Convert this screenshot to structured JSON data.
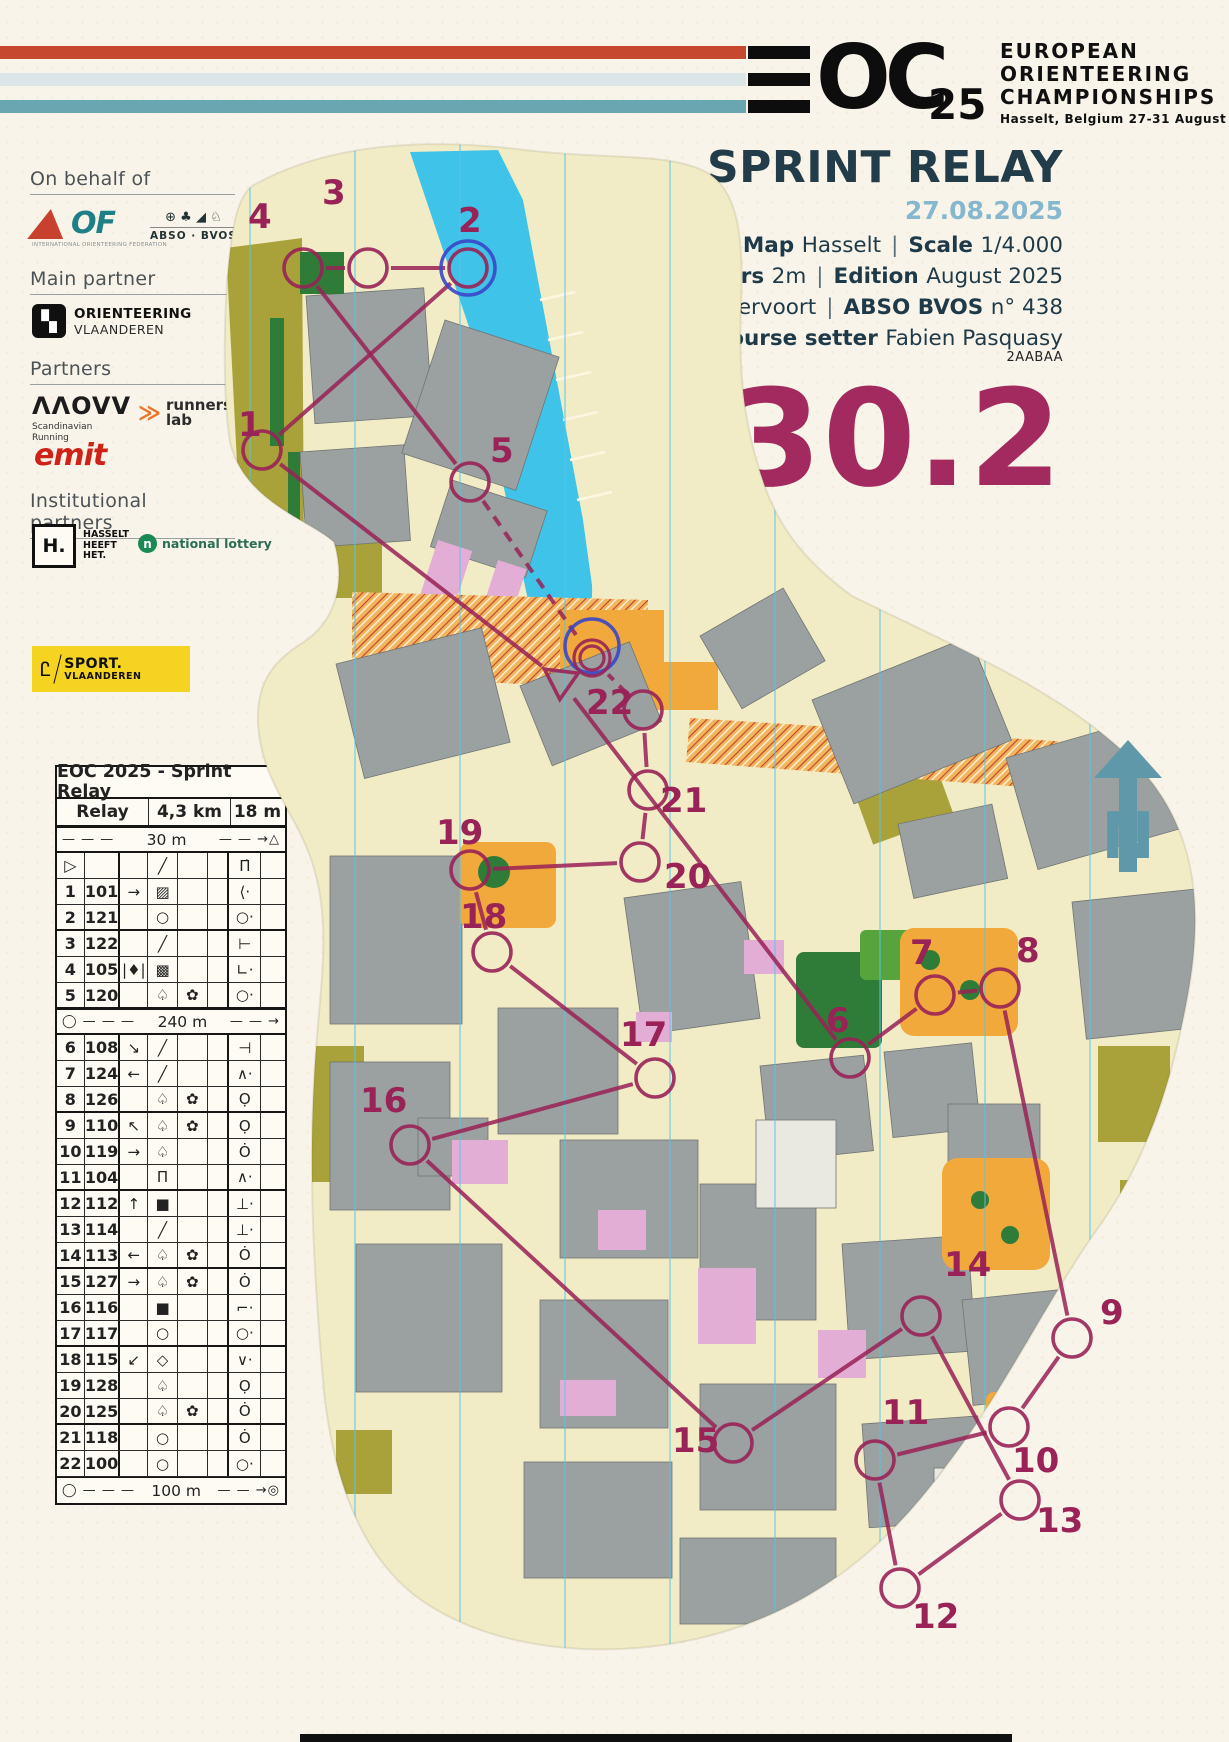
{
  "header": {
    "logo_oc": "OC",
    "logo_year": "25",
    "org1": "EUROPEAN",
    "org2": "ORIENTEERING",
    "org3": "CHAMPIONSHIPS",
    "venue": "Hasselt, Belgium  27-31 August",
    "stripe_colors": [
      "#c6482e",
      "#dce6e8",
      "#69a6b2"
    ]
  },
  "title_block": {
    "title": "SPRINT RELAY",
    "date": "27.08.2025",
    "meta": [
      [
        {
          "label": "Map",
          "value": "Hasselt"
        },
        {
          "label": "Scale",
          "value": "1/4.000"
        }
      ],
      [
        {
          "label": "Contours",
          "value": "2m"
        },
        {
          "label": "Edition",
          "value": "August 2025"
        }
      ],
      [
        {
          "label": "Mapper",
          "value": "Karl Vervoort"
        },
        {
          "label": "ABSO BVOS",
          "value": "n° 438"
        }
      ],
      [
        {
          "label": "Course setter",
          "value": "Fabien Pasquasy"
        }
      ]
    ],
    "code": "2AABAA",
    "course_number": "30.2"
  },
  "sponsors": {
    "on_behalf_heading": "On behalf of",
    "iof_of": "OF",
    "iof_caption": "INTERNATIONAL ORIENTEERING FEDERATION",
    "abso_icons": "⊕ ♣ ◢ ♘",
    "abso_label": "ABSO · BVOS",
    "main_partner_heading": "Main partner",
    "ov_icon": "▚",
    "ov_line1": "ORIENTEERING",
    "ov_line2": "VLAANDEREN",
    "partners_heading": "Partners",
    "movv_logo": "ΛΛOVV",
    "movv_cap1": "Scandinavian",
    "movv_cap2": "Running",
    "runners_icon": "≫",
    "runners_line1": "runners'",
    "runners_line2": "lab",
    "emit": "emit",
    "institutional_heading": "Institutional partners",
    "hasselt_logo": "H.",
    "hasselt_cap1": "HASSELT",
    "hasselt_cap2": "HEEFT",
    "hasselt_cap3": "HET.",
    "lottery_icon": "n",
    "lottery_label": "national lottery",
    "sport_line1": "SPORT.",
    "sport_line2": "VLAANDEREN"
  },
  "control_card": {
    "title": "EOC 2025 - Sprint Relay",
    "class_name": "Relay",
    "distance": "4,3 km",
    "climb": "18 m",
    "rows": [
      {
        "t": "head"
      },
      {
        "t": "dist",
        "lead": "",
        "label": "30 m",
        "tail": "△"
      },
      {
        "t": "row",
        "n": "▷",
        "code": "",
        "c": "",
        "d": "╱",
        "e": "",
        "f": "",
        "g": "Π̇",
        "h": ""
      },
      {
        "t": "row",
        "n": "1",
        "code": "101",
        "c": "→",
        "d": "▨",
        "e": "",
        "f": "",
        "g": "⟨·",
        "h": ""
      },
      {
        "t": "row",
        "n": "2",
        "code": "121",
        "c": "",
        "d": "○",
        "e": "",
        "f": "",
        "g": "○·",
        "h": "",
        "hb": true
      },
      {
        "t": "row",
        "n": "3",
        "code": "122",
        "c": "",
        "d": "╱",
        "e": "",
        "f": "",
        "g": "⊢",
        "h": ""
      },
      {
        "t": "row",
        "n": "4",
        "code": "105",
        "c": "|♦|",
        "d": "▩",
        "e": "",
        "f": "",
        "g": "∟·",
        "h": ""
      },
      {
        "t": "row",
        "n": "5",
        "code": "120",
        "c": "",
        "d": "♤",
        "e": "✿",
        "f": "",
        "g": "○·",
        "h": "",
        "hb": true
      },
      {
        "t": "dist",
        "lead": "◯",
        "label": "240 m",
        "tail": ""
      },
      {
        "t": "row",
        "n": "6",
        "code": "108",
        "c": "↘",
        "d": "╱",
        "e": "",
        "f": "",
        "g": "⊣",
        "h": ""
      },
      {
        "t": "row",
        "n": "7",
        "code": "124",
        "c": "←",
        "d": "╱",
        "e": "",
        "f": "",
        "g": "∧·",
        "h": ""
      },
      {
        "t": "row",
        "n": "8",
        "code": "126",
        "c": "",
        "d": "♤",
        "e": "✿",
        "f": "",
        "g": "Ọ",
        "h": "",
        "hb": true
      },
      {
        "t": "row",
        "n": "9",
        "code": "110",
        "c": "↖",
        "d": "♤",
        "e": "✿",
        "f": "",
        "g": "Ọ",
        "h": ""
      },
      {
        "t": "row",
        "n": "10",
        "code": "119",
        "c": "→",
        "d": "♤",
        "e": "",
        "f": "",
        "g": "Ȯ",
        "h": ""
      },
      {
        "t": "row",
        "n": "11",
        "code": "104",
        "c": "",
        "d": "Π",
        "e": "",
        "f": "",
        "g": "∧·",
        "h": "",
        "hb": true
      },
      {
        "t": "row",
        "n": "12",
        "code": "112",
        "c": "↑",
        "d": "■",
        "e": "",
        "f": "",
        "g": "⊥·",
        "h": ""
      },
      {
        "t": "row",
        "n": "13",
        "code": "114",
        "c": "",
        "d": "╱",
        "e": "",
        "f": "",
        "g": "⊥·",
        "h": ""
      },
      {
        "t": "row",
        "n": "14",
        "code": "113",
        "c": "←",
        "d": "♤",
        "e": "✿",
        "f": "",
        "g": "Ȯ",
        "h": "",
        "hb": true
      },
      {
        "t": "row",
        "n": "15",
        "code": "127",
        "c": "→",
        "d": "♤",
        "e": "✿",
        "f": "",
        "g": "Ȯ",
        "h": ""
      },
      {
        "t": "row",
        "n": "16",
        "code": "116",
        "c": "",
        "d": "■",
        "e": "",
        "f": "",
        "g": "⌐·",
        "h": ""
      },
      {
        "t": "row",
        "n": "17",
        "code": "117",
        "c": "",
        "d": "○",
        "e": "",
        "f": "",
        "g": "○·",
        "h": "",
        "hb": true
      },
      {
        "t": "row",
        "n": "18",
        "code": "115",
        "c": "↙",
        "d": "◇",
        "e": "",
        "f": "",
        "g": "∨·",
        "h": ""
      },
      {
        "t": "row",
        "n": "19",
        "code": "128",
        "c": "",
        "d": "♤",
        "e": "",
        "f": "",
        "g": "Ọ",
        "h": ""
      },
      {
        "t": "row",
        "n": "20",
        "code": "125",
        "c": "",
        "d": "♤",
        "e": "✿",
        "f": "",
        "g": "Ȯ",
        "h": "",
        "hb": true
      },
      {
        "t": "row",
        "n": "21",
        "code": "118",
        "c": "",
        "d": "○",
        "e": "",
        "f": "",
        "g": "Ȯ",
        "h": ""
      },
      {
        "t": "row",
        "n": "22",
        "code": "100",
        "c": "",
        "d": "○",
        "e": "",
        "f": "",
        "g": "○·",
        "h": ""
      },
      {
        "t": "dist",
        "lead": "◯",
        "label": "100 m",
        "tail": "◎"
      }
    ]
  },
  "map": {
    "north_label": "N",
    "course_color": "#992257",
    "exchange_color": "#3947c8",
    "north_line_color": "#55c6ea",
    "start": {
      "x": 560,
      "y": 680
    },
    "finish": {
      "x": 592,
      "y": 658
    },
    "controls": [
      {
        "n": 1,
        "x": 262,
        "y": 450,
        "lx": 238,
        "ly": 436
      },
      {
        "n": 2,
        "x": 468,
        "y": 268,
        "lx": 458,
        "ly": 232
      },
      {
        "n": 3,
        "x": 368,
        "y": 268,
        "lx": 322,
        "ly": 204
      },
      {
        "n": 4,
        "x": 303,
        "y": 268,
        "lx": 248,
        "ly": 228
      },
      {
        "n": 5,
        "x": 470,
        "y": 482,
        "lx": 490,
        "ly": 462
      },
      {
        "n": 6,
        "x": 850,
        "y": 1058,
        "lx": 826,
        "ly": 1032
      },
      {
        "n": 7,
        "x": 935,
        "y": 995,
        "lx": 910,
        "ly": 964
      },
      {
        "n": 8,
        "x": 1000,
        "y": 988,
        "lx": 1016,
        "ly": 962
      },
      {
        "n": 9,
        "x": 1072,
        "y": 1338,
        "lx": 1100,
        "ly": 1324
      },
      {
        "n": 10,
        "x": 1009,
        "y": 1427,
        "lx": 1012,
        "ly": 1472
      },
      {
        "n": 11,
        "x": 875,
        "y": 1460,
        "lx": 882,
        "ly": 1424
      },
      {
        "n": 12,
        "x": 900,
        "y": 1588,
        "lx": 912,
        "ly": 1628
      },
      {
        "n": 13,
        "x": 1020,
        "y": 1500,
        "lx": 1036,
        "ly": 1532
      },
      {
        "n": 14,
        "x": 921,
        "y": 1316,
        "lx": 944,
        "ly": 1276
      },
      {
        "n": 15,
        "x": 733,
        "y": 1443,
        "lx": 672,
        "ly": 1452
      },
      {
        "n": 16,
        "x": 410,
        "y": 1145,
        "lx": 360,
        "ly": 1112
      },
      {
        "n": 17,
        "x": 655,
        "y": 1078,
        "lx": 620,
        "ly": 1046
      },
      {
        "n": 18,
        "x": 492,
        "y": 952,
        "lx": 460,
        "ly": 928
      },
      {
        "n": 19,
        "x": 470,
        "y": 870,
        "lx": 436,
        "ly": 844
      },
      {
        "n": 20,
        "x": 640,
        "y": 862,
        "lx": 664,
        "ly": 888
      },
      {
        "n": 21,
        "x": 648,
        "y": 790,
        "lx": 660,
        "ly": 812
      },
      {
        "n": 22,
        "x": 643,
        "y": 710,
        "lx": 586,
        "ly": 714
      }
    ],
    "legs_solid": [
      [
        "S",
        1
      ],
      [
        1,
        2
      ],
      [
        2,
        3
      ],
      [
        3,
        4
      ],
      [
        4,
        5
      ],
      [
        "S",
        6
      ],
      [
        6,
        7
      ],
      [
        7,
        8
      ],
      [
        8,
        9
      ],
      [
        9,
        10
      ],
      [
        10,
        11
      ],
      [
        11,
        12
      ],
      [
        12,
        13
      ],
      [
        13,
        14
      ],
      [
        14,
        15
      ],
      [
        15,
        16
      ],
      [
        16,
        17
      ],
      [
        17,
        18
      ],
      [
        18,
        19
      ],
      [
        19,
        20
      ],
      [
        20,
        21
      ],
      [
        21,
        22
      ]
    ],
    "legs_dashed": [
      [
        5,
        "F"
      ],
      [
        22,
        "F"
      ]
    ],
    "exchange_rings": [
      2,
      "F"
    ]
  }
}
